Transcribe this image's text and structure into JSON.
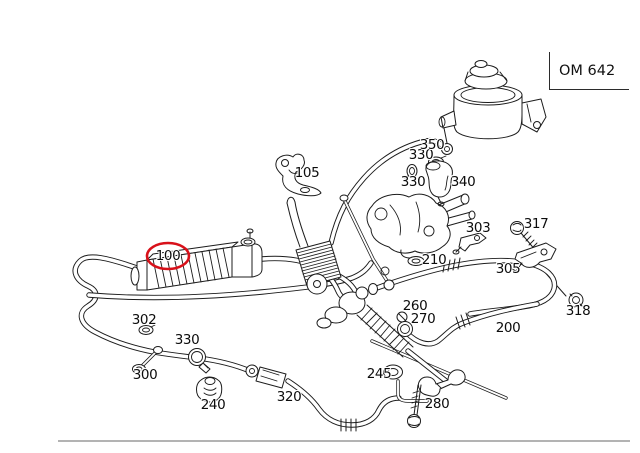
{
  "colors": {
    "line": "#1c1c1c",
    "highlight": "#d8111a",
    "rule": "#b3b3b3",
    "background": "#ffffff"
  },
  "engine_code_box": {
    "label": "OM 642"
  },
  "diagram": {
    "highlighted_part_id": "100",
    "labels": [
      {
        "id": "100",
        "text": "100",
        "x": 168,
        "y": 256
      },
      {
        "id": "105",
        "text": "105",
        "x": 307,
        "y": 173
      },
      {
        "id": "200",
        "text": "200",
        "x": 508,
        "y": 328
      },
      {
        "id": "210",
        "text": "210",
        "x": 434,
        "y": 260
      },
      {
        "id": "240",
        "text": "240",
        "x": 213,
        "y": 405
      },
      {
        "id": "245",
        "text": "245",
        "x": 379,
        "y": 374
      },
      {
        "id": "260",
        "text": "260",
        "x": 415,
        "y": 306
      },
      {
        "id": "270",
        "text": "270",
        "x": 423,
        "y": 319
      },
      {
        "id": "280",
        "text": "280",
        "x": 437,
        "y": 404
      },
      {
        "id": "300",
        "text": "300",
        "x": 145,
        "y": 375
      },
      {
        "id": "302",
        "text": "302",
        "x": 144,
        "y": 320
      },
      {
        "id": "303",
        "text": "303",
        "x": 478,
        "y": 228
      },
      {
        "id": "305",
        "text": "305",
        "x": 508,
        "y": 269
      },
      {
        "id": "317",
        "text": "317",
        "x": 536,
        "y": 224
      },
      {
        "id": "318",
        "text": "318",
        "x": 578,
        "y": 311
      },
      {
        "id": "320",
        "text": "320",
        "x": 289,
        "y": 397
      },
      {
        "id": "330-a",
        "text": "330",
        "x": 421,
        "y": 155
      },
      {
        "id": "330-b",
        "text": "330",
        "x": 413,
        "y": 182
      },
      {
        "id": "330-c",
        "text": "330",
        "x": 187,
        "y": 340
      },
      {
        "id": "340",
        "text": "340",
        "x": 463,
        "y": 182
      },
      {
        "id": "350",
        "text": "350",
        "x": 432,
        "y": 145
      }
    ]
  }
}
